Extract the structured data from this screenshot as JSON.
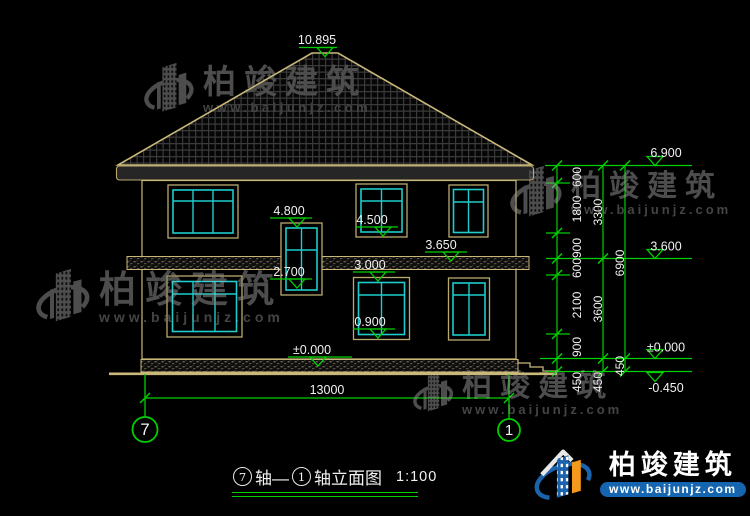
{
  "watermark": {
    "brand": "柏竣建筑",
    "url": "www.baijunjz.com"
  },
  "footer_brand": {
    "name": "柏竣建筑",
    "url": "www.baijunjz.com"
  },
  "title_block": {
    "axis_start_no": "7",
    "axis_join": "轴—",
    "axis_end_no": "1",
    "name": "轴立面图",
    "scale": "1:100"
  },
  "markers": {
    "ridge": "10.895",
    "stair_window_head": "4.800",
    "upper_window_sill": "4.500",
    "belt_left": "3.650",
    "stair_window_sill": "2.700",
    "lower_window_head": "3.000",
    "lower_window_sill": "0.900",
    "ground_left": "±0.000",
    "eave": "6.900",
    "belt_right": "3.600",
    "ground_right": "±0.000",
    "foundation": "-0.450"
  },
  "dim_chains": {
    "inner": [
      "600",
      "1800",
      "900",
      "600",
      "2100",
      "900",
      "450"
    ],
    "middle": [
      "3300",
      "3600",
      "450"
    ],
    "outer": [
      "6900",
      "450"
    ]
  },
  "overall_width": "13000",
  "axis_bubbles": {
    "left": "7",
    "right": "1"
  }
}
